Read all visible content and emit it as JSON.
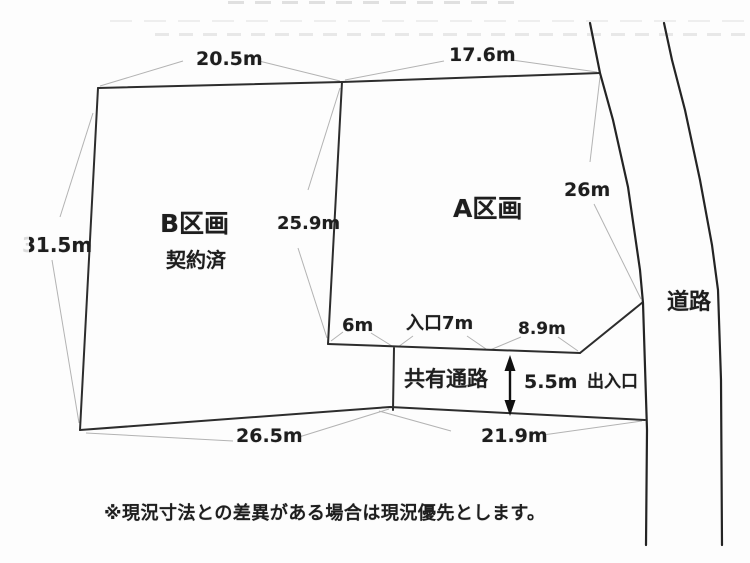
{
  "parcels": {
    "a": {
      "label": "A区画"
    },
    "b": {
      "label": "B区画",
      "status": "契約済"
    }
  },
  "passage": {
    "label": "共有通路",
    "exit": "出入口"
  },
  "road": {
    "label": "道路"
  },
  "dims": {
    "b_top": "20.5m",
    "a_top": "17.6m",
    "a_right": "26m",
    "boundary": "25.9m",
    "b_left": "31.5m",
    "b_bottom": "26.5m",
    "passage_bottom": "21.9m",
    "b_frontage": "6m",
    "entrance": "入口7m",
    "a_frontage": "8.9m",
    "passage_width": "5.5m"
  },
  "note": "※現況寸法との差異がある場合は現況優先とします。"
}
